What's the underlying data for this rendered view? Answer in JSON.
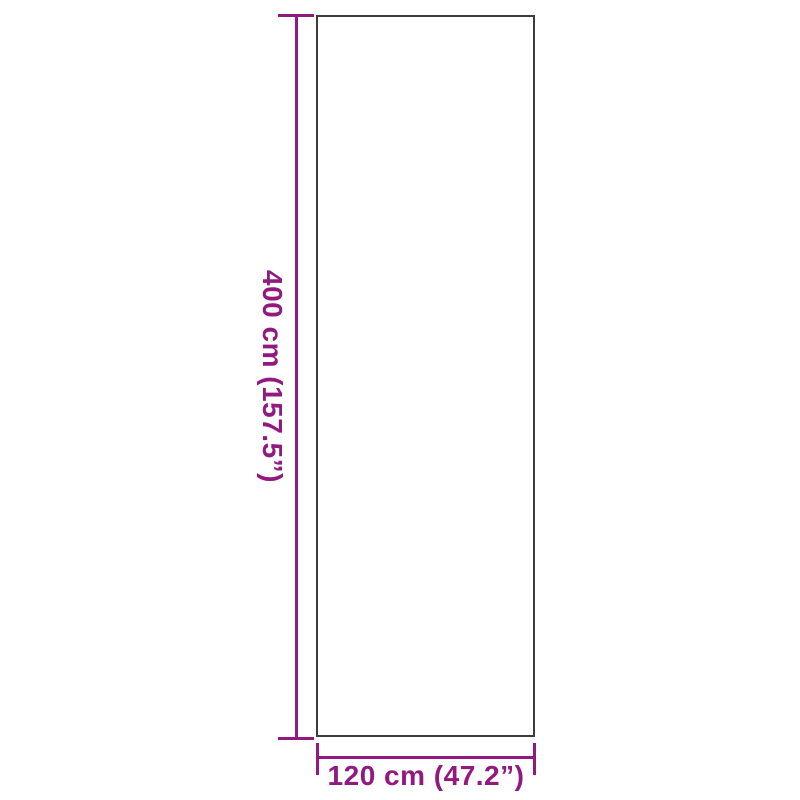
{
  "diagram": {
    "type": "product-dimension-drawing",
    "colors": {
      "accent": "#91197F",
      "outline": "#3D3D3D",
      "background": "#FFFFFF"
    },
    "height_dimension": {
      "label": "400 cm (157.5”)",
      "value_cm": 400,
      "value_inches": 157.5
    },
    "width_dimension": {
      "label": "120 cm (47.2”)",
      "value_cm": 120,
      "value_inches": 47.2
    }
  }
}
